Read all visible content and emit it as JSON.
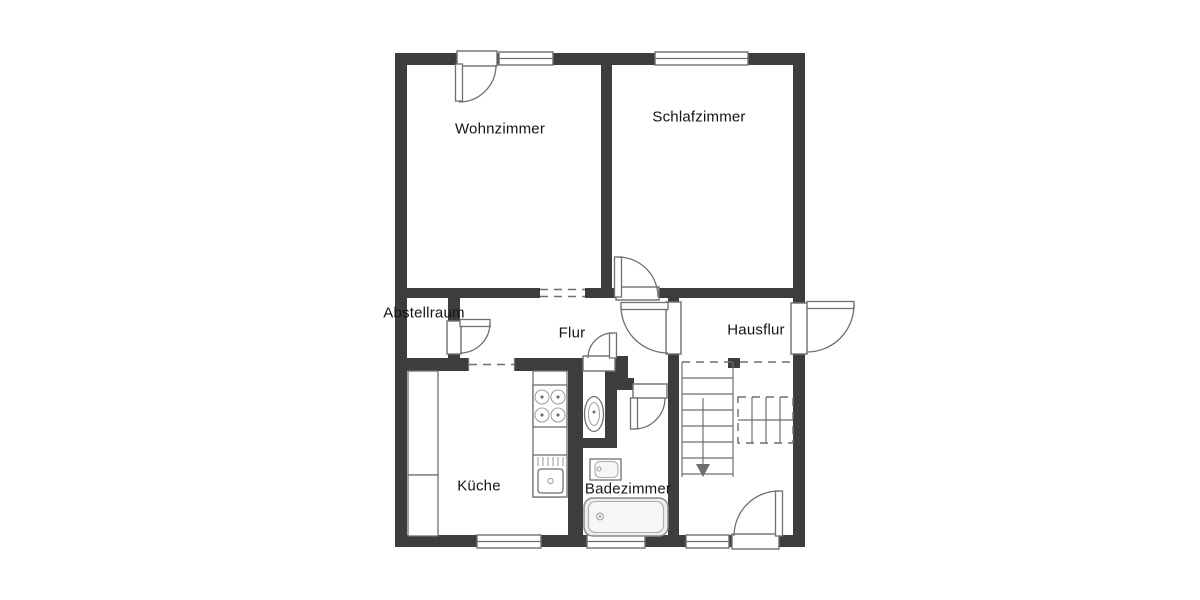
{
  "page": {
    "background": "#ffffff"
  },
  "colors": {
    "wall": "#3d3d3d",
    "line": "#6f6f6f",
    "line_light": "#a3a3a3",
    "text": "#141414",
    "fixture_fill": "#ededed"
  },
  "rooms": [
    {
      "id": "wohnzimmer",
      "label": "Wohnzimmer"
    },
    {
      "id": "schlafzimmer",
      "label": "Schlafzimmer"
    },
    {
      "id": "abstellraum",
      "label": "Abstellraum"
    },
    {
      "id": "flur",
      "label": "Flur"
    },
    {
      "id": "hausflur",
      "label": "Hausflur"
    },
    {
      "id": "kueche",
      "label": "Küche"
    },
    {
      "id": "badezimmer",
      "label": "Badezimmer"
    }
  ],
  "fixtures": [
    "staircase-with-down-arrow",
    "stove-four-burners",
    "kitchen-sink-with-drainer",
    "built-in-closet",
    "toilet",
    "washbasin",
    "bathtub"
  ]
}
